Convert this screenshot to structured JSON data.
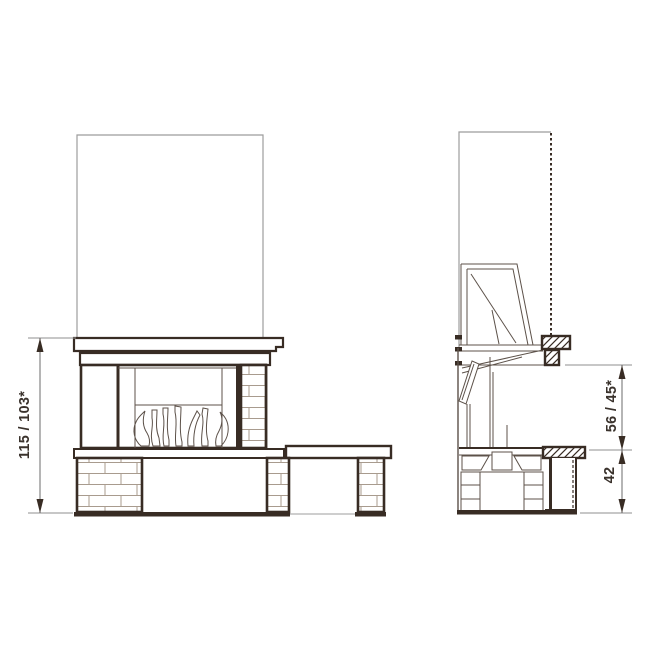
{
  "drawing": {
    "kind": "fireplace technical drawing, front and side elevation"
  },
  "labels": {
    "height_total": "115 / 103*",
    "side_upper": "56 / 45*",
    "side_lower": "42"
  },
  "colors": {
    "line_dark": "#382c24",
    "line_mid": "#5c5149",
    "line_light": "#9c9c9c",
    "brick_joint": "#a89b8e",
    "dim_line": "#6b6b6b",
    "text": "#3a322c",
    "background": "#ffffff"
  }
}
